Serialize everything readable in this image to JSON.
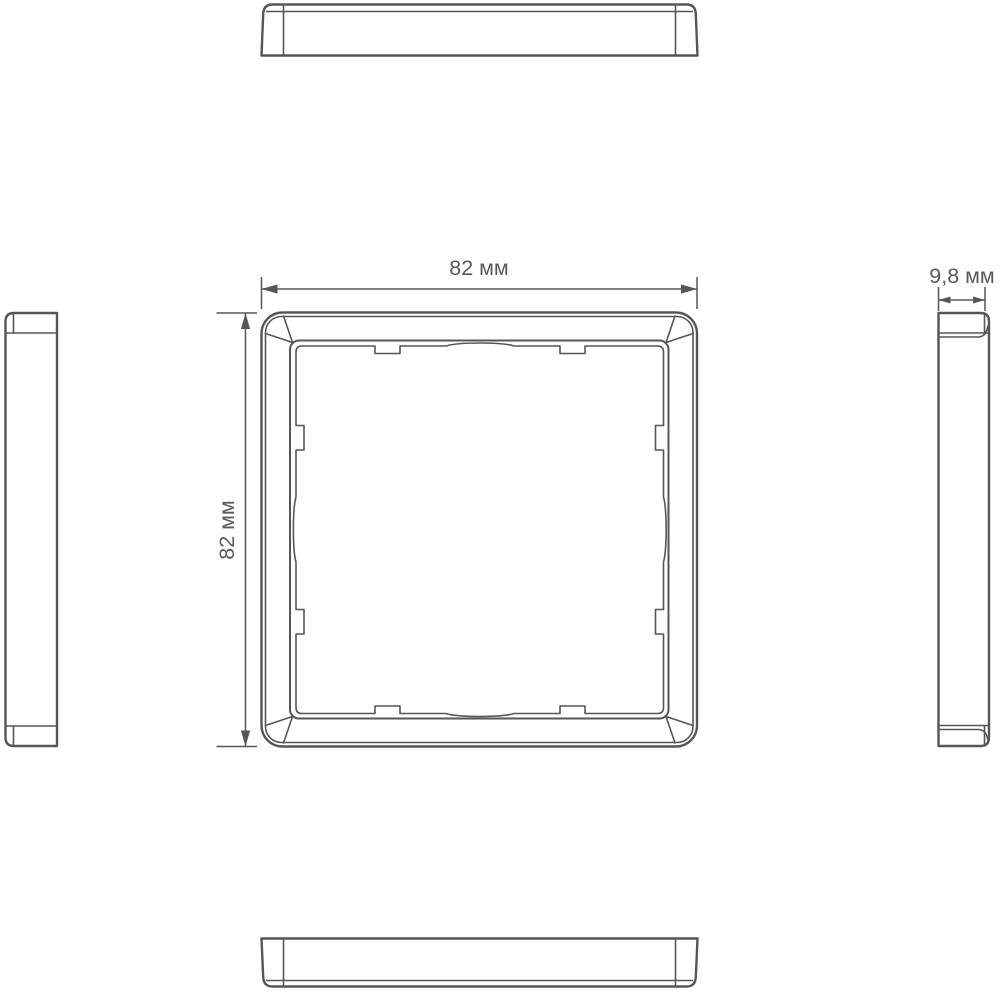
{
  "drawing": {
    "kind": "technical-drawing",
    "background_color": "#ffffff",
    "line_color": "#54565a",
    "text_color": "#58595b",
    "dimensions": {
      "width": {
        "label": "82 мм",
        "value": 82,
        "unit": "мм"
      },
      "height": {
        "label": "82 мм",
        "value": 82,
        "unit": "мм"
      },
      "depth": {
        "label": "9,8 мм",
        "value": 9.8,
        "unit": "мм"
      }
    }
  }
}
